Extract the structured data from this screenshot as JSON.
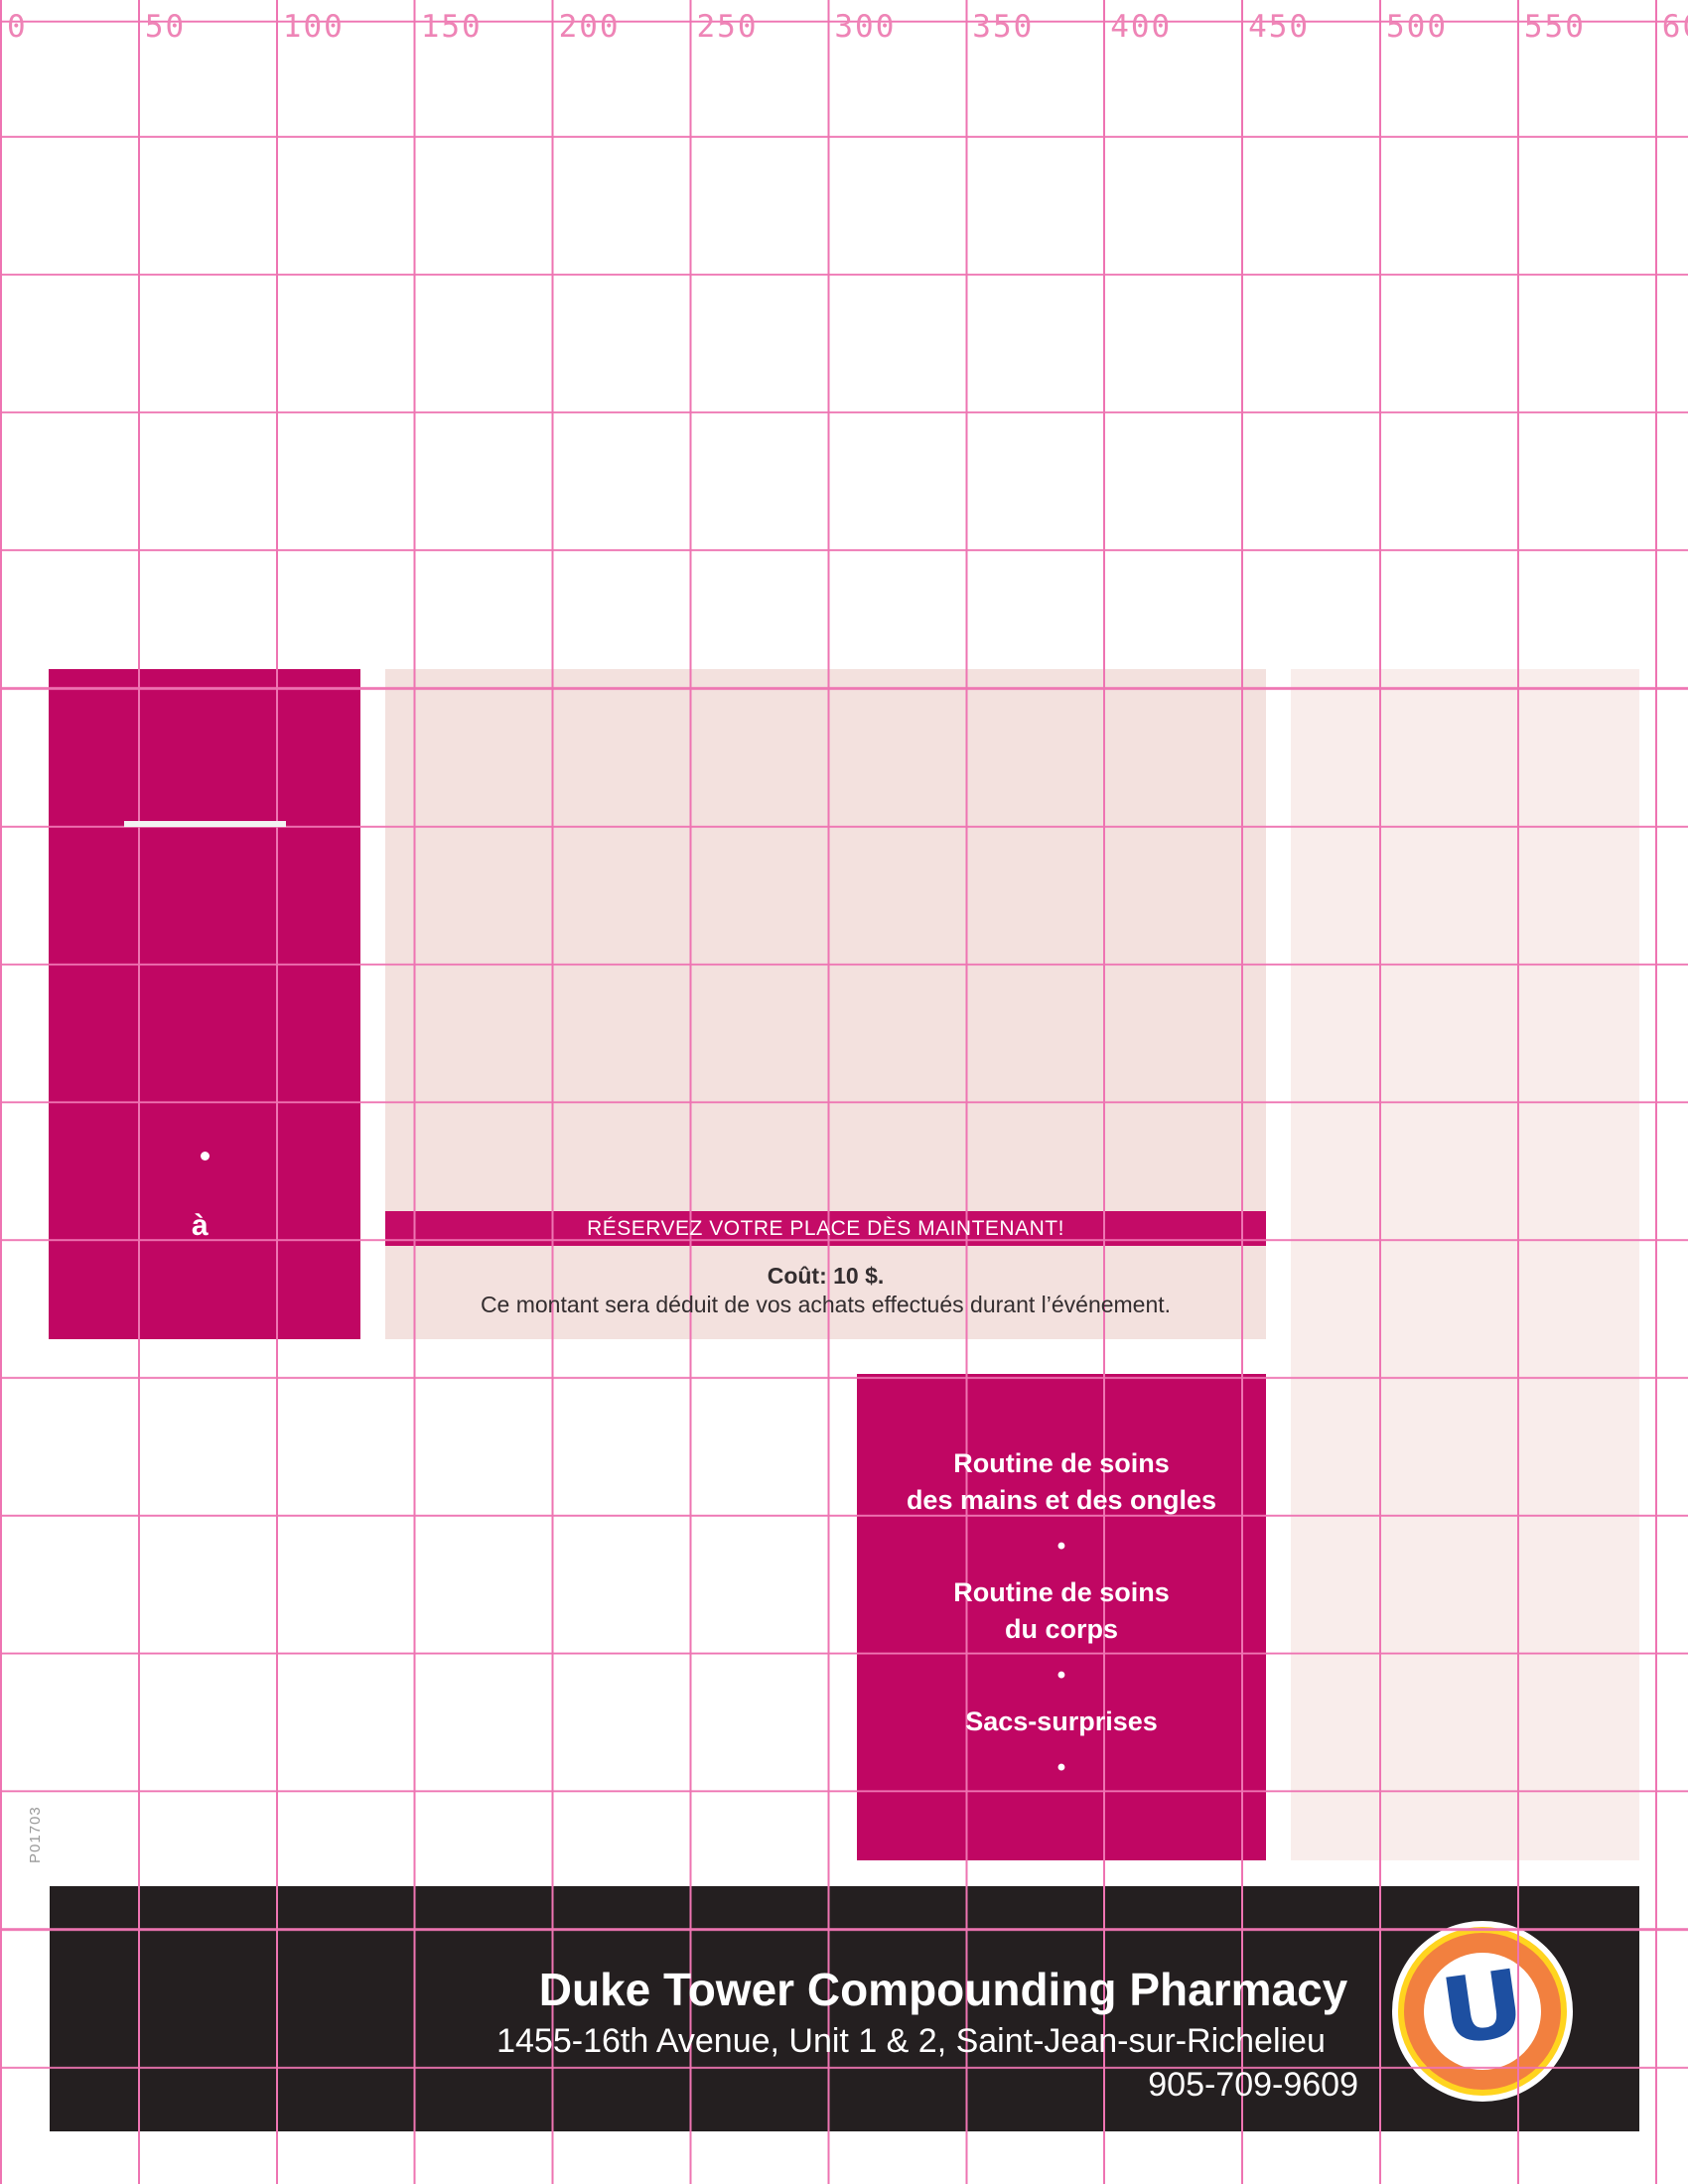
{
  "colors": {
    "magenta": "#c00663",
    "banner_magenta": "#c40b67",
    "panel_pink": "#f3e1de",
    "panel_pink_light": "#f9edeb",
    "footer_black": "#241f20",
    "grid_pink": "#ee74b2",
    "ruler_pink": "#ee84b6",
    "text_dark": "#332d2f",
    "logo_blue": "#1d4fa1",
    "logo_orange": "#f2803f",
    "logo_yellow": "#ffd41f"
  },
  "ruler": {
    "labels": [
      "0",
      "50",
      "100",
      "150",
      "200",
      "250",
      "300",
      "350",
      "400",
      "450",
      "500",
      "550",
      "600"
    ]
  },
  "proof_code": "P01703",
  "left_panel": {
    "bullet": "•",
    "fragment": "à"
  },
  "main_panel": {
    "banner": "RÉSERVEZ VOTRE PLACE DÈS MAINTENANT!",
    "cost": "Coût: 10 $.",
    "note": "Ce montant sera déduit de vos achats effectués durant l’événement."
  },
  "services": {
    "bullet": "•",
    "blocks": [
      [
        "Routine de soins",
        "des mains et des ongles"
      ],
      [
        "Routine de soins",
        "du corps"
      ],
      [
        "Sacs-surprises"
      ]
    ]
  },
  "footer": {
    "name": "Duke Tower Compounding Pharmacy",
    "address": "1455-16th Avenue, Unit 1 & 2, Saint-Jean-sur-Richelieu",
    "phone": "905-709-9609",
    "logo_letter": "U"
  }
}
